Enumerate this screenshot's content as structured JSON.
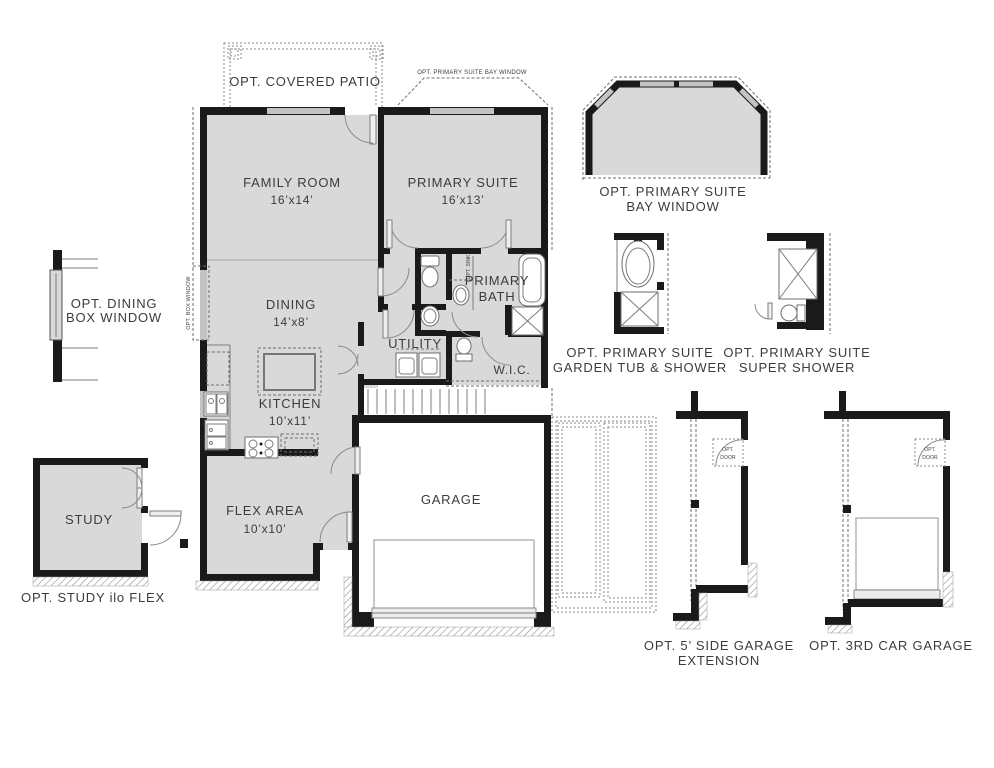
{
  "rooms": {
    "family_room": {
      "name": "FAMILY ROOM",
      "dims": "16’x14’"
    },
    "primary_suite": {
      "name": "PRIMARY SUITE",
      "dims": "16’x13’"
    },
    "dining": {
      "name": "DINING",
      "dims": "14’x8’"
    },
    "kitchen": {
      "name": "KITCHEN",
      "dims": "10’x11’"
    },
    "utility": {
      "name": "UTILITY"
    },
    "primary_bath": {
      "line1": "PRIMARY",
      "line2": "BATH"
    },
    "wic": {
      "name": "W.I.C."
    },
    "flex_area": {
      "name": "FLEX AREA",
      "dims": "10’x10’"
    },
    "garage": {
      "name": "GARAGE"
    },
    "study": {
      "name": "STUDY"
    }
  },
  "annotations": {
    "covered_patio": "OPT. COVERED PATIO",
    "bay_window_note": "OPT. PRIMARY SUITE BAY WINDOW",
    "box_window_note": "OPT. BOX WINDOW",
    "sink_note": "OPT. SINK",
    "opt_door_line1": "OPT.",
    "opt_door_line2": "DOOR"
  },
  "options": {
    "dining_box_window": {
      "line1": "OPT. DINING",
      "line2": "BOX WINDOW"
    },
    "primary_bay_window": {
      "line1": "OPT. PRIMARY SUITE",
      "line2": "BAY WINDOW"
    },
    "garden_tub": {
      "line1": "OPT. PRIMARY SUITE",
      "line2": "GARDEN TUB & SHOWER"
    },
    "super_shower": {
      "line1": "OPT. PRIMARY SUITE",
      "line2": "SUPER SHOWER"
    },
    "study_ilo_flex": {
      "caption": "OPT. STUDY ilo FLEX"
    },
    "side_garage_extension": {
      "line1": "OPT. 5’ SIDE GARAGE",
      "line2": "EXTENSION"
    },
    "third_car_garage": {
      "caption": "OPT. 3RD CAR GARAGE"
    }
  },
  "colors": {
    "floor_fill": "#d9d9d9",
    "wall": "#1a1a1a",
    "text": "#3c3c3c",
    "window": "#c3c3c3"
  }
}
